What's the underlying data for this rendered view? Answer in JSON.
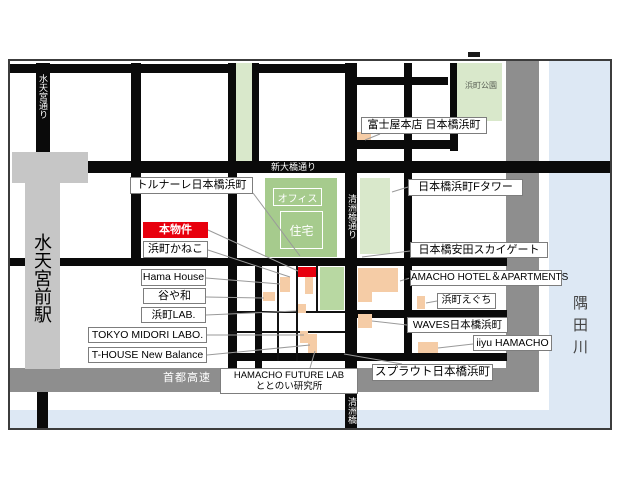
{
  "streets": {
    "suitengu_dori": "水天宮通り",
    "shin_ohashi_dori": "新大橋通り",
    "kiyosubashi_dori": "清洲橋通り",
    "kiyosubashi_bridge": "清洲橋",
    "shuto_expressway": "首都高速"
  },
  "features": {
    "station": "水天宮前駅",
    "river": "隅田川",
    "park": "浜町公園",
    "zone_office": "オフィス",
    "zone_residential": "住宅"
  },
  "property_label": "本物件",
  "labels": {
    "fujiya": "富士屋本店 日本橋浜町",
    "tornare": "トルナーレ日本橋浜町",
    "f_tower": "日本橋浜町Fタワー",
    "kaneko": "浜町かねこ",
    "yasuda_skygate": "日本橋安田スカイゲート",
    "hama_house": "Hama House",
    "hamacho_hotel": "HAMACHO HOTEL＆APARTMENTS",
    "taniyawa": "谷や和",
    "eguchi": "浜町えぐち",
    "hamacho_lab": "浜町LAB.",
    "waves": "WAVES日本橋浜町",
    "tokyo_midori_labo": "TOKYO MIDORI LABO.",
    "iiyu": "iiyu HAMACHO",
    "t_house": "T-HOUSE New Balance",
    "sprout": "スプラウト日本橋浜町",
    "future_lab_line1": "HAMACHO FUTURE LAB",
    "future_lab_line2": "ととのい研究所"
  },
  "colors": {
    "road_black": "#0a0a0a",
    "expressway_gray": "#8e8e8e",
    "station_gray": "#c6c6c6",
    "river_blue": "#dde8f4",
    "park_green": "#d9e8cb",
    "block_green": "#a6cb8d",
    "building_orange": "#f5cca6",
    "property_red": "#e8000d"
  }
}
